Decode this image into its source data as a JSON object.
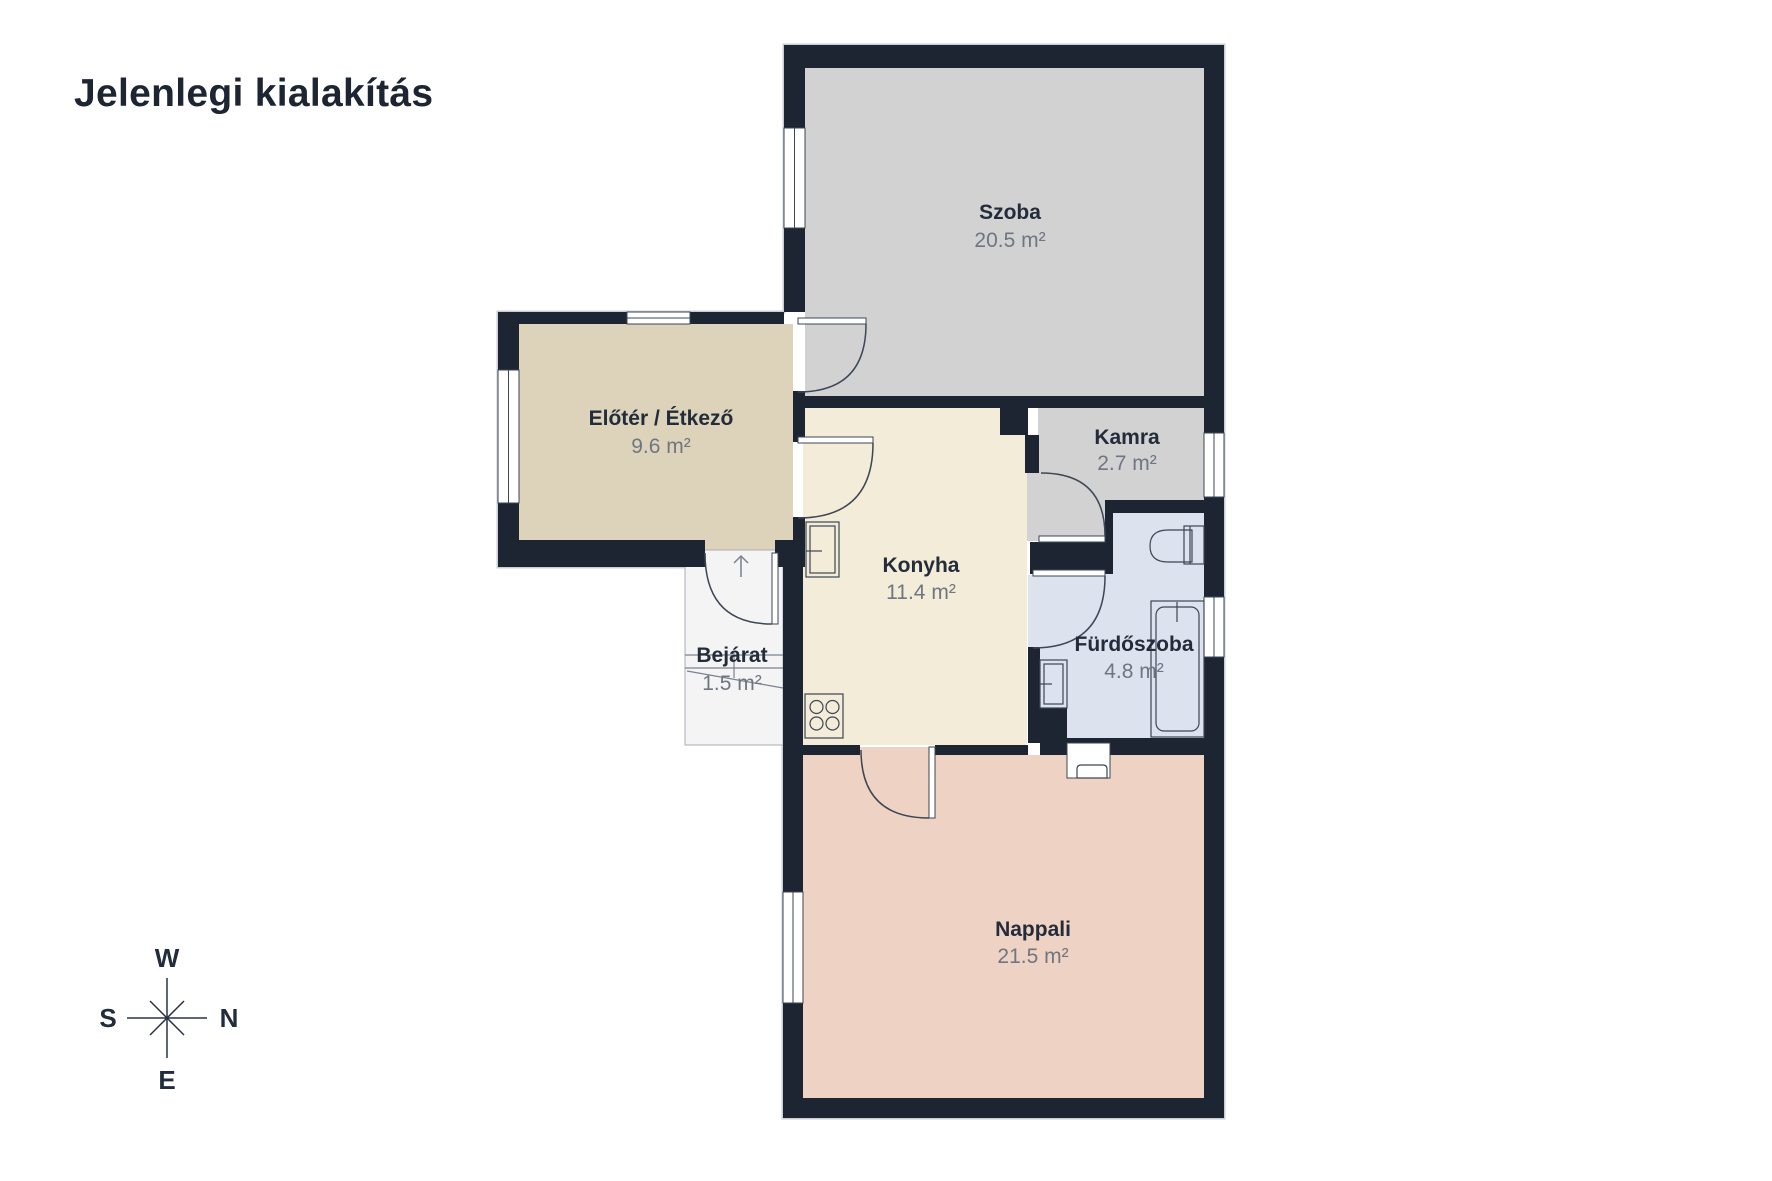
{
  "title": "Jelenlegi kialakítás",
  "rooms": {
    "szoba": {
      "name": "Szoba",
      "area": "20.5 m²"
    },
    "eloter": {
      "name": "Előtér / Étkező",
      "area": "9.6 m²"
    },
    "kamra": {
      "name": "Kamra",
      "area": "2.7 m²"
    },
    "konyha": {
      "name": "Konyha",
      "area": "11.4 m²"
    },
    "furdoszoba": {
      "name": "Fürdőszoba",
      "area": "4.8 m²"
    },
    "bejarat": {
      "name": "Bejárat",
      "area": "1.5 m²"
    },
    "nappali": {
      "name": "Nappali",
      "area": "21.5 m²"
    }
  },
  "compass": {
    "top": "W",
    "right": "N",
    "left": "S",
    "bottom": "E"
  },
  "colors": {
    "wall": "#1e2532",
    "szoba_floor": "#d2d2d2",
    "kamra_floor": "#d2d2d2",
    "eloter_floor": "#ddd3ba",
    "konyha_floor": "#f3ecd8",
    "furdoszoba_floor": "#dde3ee",
    "nappali_floor": "#eed2c3",
    "bejarat_floor": "#f4f4f4",
    "detail_line": "#3c4654",
    "room_label": "#232c3b",
    "area_label": "#6f7682",
    "title_color": "#1d2533"
  }
}
